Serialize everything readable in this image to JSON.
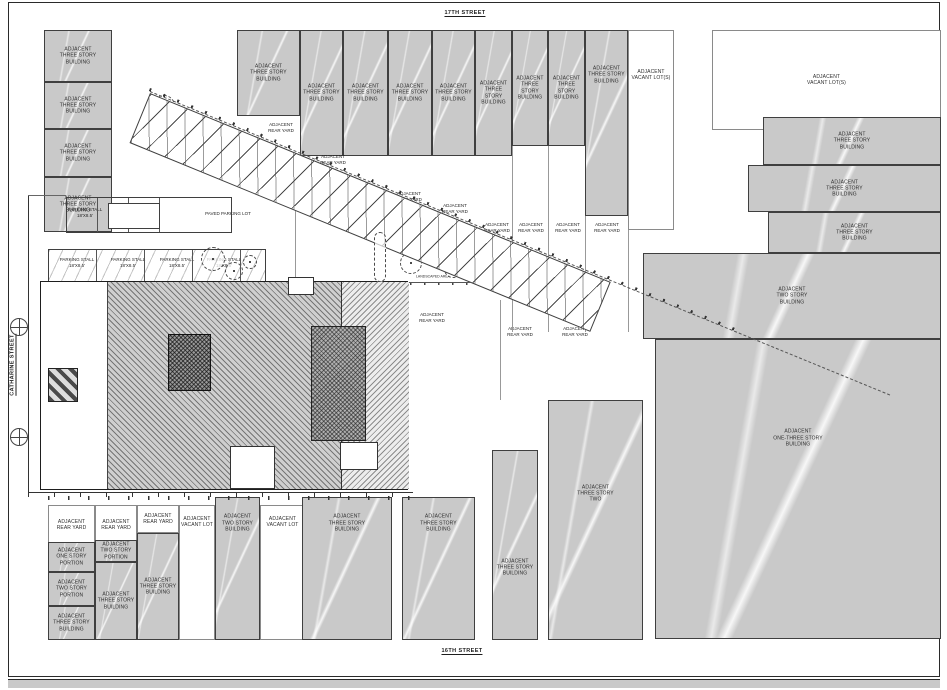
{
  "sheet": {
    "streets": {
      "top": "17TH STREET",
      "bottom": "16TH STREET",
      "left": "CATHARINE STREET",
      "right": "FITZWATER STREET"
    },
    "colors": {
      "parcel_fill": "#c9c9c9",
      "parcel_border": "#3f3f3f",
      "paper": "#ffffff",
      "line": "#4a4a4a"
    }
  },
  "parcels": [
    {
      "text": "ADJACENT\nTHREE STORY\nBUILDING",
      "x": 44,
      "y": 30,
      "w": 68,
      "h": 52,
      "fill": "gray"
    },
    {
      "text": "ADJACENT\nTHREE STORY\nBUILDING",
      "x": 44,
      "y": 82,
      "w": 68,
      "h": 47,
      "fill": "gray"
    },
    {
      "text": "ADJACENT\nTHREE STORY\nBUILDING",
      "x": 44,
      "y": 129,
      "w": 68,
      "h": 48,
      "fill": "gray"
    },
    {
      "text": "ADJACENT\nTHREE STORY\nBUILDING",
      "x": 44,
      "y": 177,
      "w": 68,
      "h": 55,
      "fill": "gray"
    },
    {
      "text": "ADJACENT\nTHREE STORY\nBUILDING",
      "x": 237,
      "y": 30,
      "w": 63,
      "h": 86,
      "fill": "gray"
    },
    {
      "text": "ADJACENT\nTHREE STORY\nBUILDING",
      "x": 300,
      "y": 30,
      "w": 43,
      "h": 126,
      "fill": "gray"
    },
    {
      "text": "ADJACENT\nTHREE STORY\nBUILDING",
      "x": 343,
      "y": 30,
      "w": 45,
      "h": 126,
      "fill": "gray"
    },
    {
      "text": "ADJACENT\nTHREE STORY\nBUILDING",
      "x": 388,
      "y": 30,
      "w": 44,
      "h": 126,
      "fill": "gray"
    },
    {
      "text": "ADJACENT\nTHREE STORY\nBUILDING",
      "x": 432,
      "y": 30,
      "w": 43,
      "h": 126,
      "fill": "gray"
    },
    {
      "text": "ADJACENT\nTHREE STORY\nBUILDING",
      "x": 475,
      "y": 30,
      "w": 37,
      "h": 126,
      "fill": "gray"
    },
    {
      "text": "ADJACENT\nTHREE STORY\nBUILDING",
      "x": 512,
      "y": 30,
      "w": 36,
      "h": 116,
      "fill": "gray"
    },
    {
      "text": "ADJACENT\nTHREE STORY\nBUILDING",
      "x": 548,
      "y": 30,
      "w": 37,
      "h": 116,
      "fill": "gray"
    },
    {
      "text": "ADJACENT\nTHREE STORY\nBUILDING",
      "x": 585,
      "y": 30,
      "w": 43,
      "h": 186,
      "fill": "gray",
      "labelY": 0.24
    },
    {
      "text": "ADJACENT\nVACANT LOT(S)",
      "x": 628,
      "y": 30,
      "w": 46,
      "h": 200,
      "fill": "white",
      "labelY": 0.22
    },
    {
      "text": "ADJACENT\nVACANT LOT(S)",
      "x": 712,
      "y": 30,
      "w": 229,
      "h": 100,
      "fill": "white"
    },
    {
      "text": "ADJACENT\nTHREE STORY\nBUILDING",
      "x": 763,
      "y": 117,
      "w": 178,
      "h": 48,
      "fill": "gray"
    },
    {
      "text": "ADJACENT\nTHREE STORY\nBUILDING",
      "x": 748,
      "y": 165,
      "w": 193,
      "h": 47,
      "fill": "gray"
    },
    {
      "text": "ADJACENT\nTHREE STORY\nBUILDING",
      "x": 768,
      "y": 212,
      "w": 173,
      "h": 41,
      "fill": "gray"
    },
    {
      "text": "ADJACENT\nTWO STORY\nBUILDING",
      "x": 643,
      "y": 253,
      "w": 298,
      "h": 86,
      "fill": "gray"
    },
    {
      "text": "ADJACENT\nONE-THREE STORY\nBUILDING",
      "x": 655,
      "y": 339,
      "w": 286,
      "h": 300,
      "fill": "gray",
      "labelY": 0.33
    },
    {
      "text": "ADJACENT\nTHREE STORY\nBUILDING",
      "x": 492,
      "y": 450,
      "w": 46,
      "h": 190,
      "fill": "gray",
      "labelY": 0.62
    },
    {
      "text": "ADJACENT\nTHREE STORY\nTWO",
      "x": 548,
      "y": 400,
      "w": 95,
      "h": 240,
      "fill": "gray",
      "labelY": 0.39
    },
    {
      "text": "ADJACENT\nREAR YARD",
      "x": 48,
      "y": 505,
      "w": 47,
      "h": 40,
      "fill": "white"
    },
    {
      "text": "ADJACENT\nREAR YARD",
      "x": 95,
      "y": 505,
      "w": 42,
      "h": 40,
      "fill": "white"
    },
    {
      "text": "ADJACENT\nREAR YARD",
      "x": 137,
      "y": 505,
      "w": 42,
      "h": 28,
      "fill": "white"
    },
    {
      "text": "ADJACENT\nVACANT LOT",
      "x": 179,
      "y": 505,
      "w": 36,
      "h": 135,
      "fill": "white",
      "labelY": 0.12
    },
    {
      "text": "ADJACENT\nTWO STORY\nBUILDING",
      "x": 215,
      "y": 497,
      "w": 45,
      "h": 143,
      "fill": "gray",
      "labelY": 0.18
    },
    {
      "text": "ADJACENT\nVACANT LOT",
      "x": 260,
      "y": 505,
      "w": 45,
      "h": 135,
      "fill": "white",
      "labelY": 0.12
    },
    {
      "text": "ADJACENT\nTHREE STORY\nBUILDING",
      "x": 302,
      "y": 497,
      "w": 90,
      "h": 143,
      "fill": "gray",
      "labelY": 0.18
    },
    {
      "text": "ADJACENT\nTHREE STORY\nBUILDING",
      "x": 402,
      "y": 497,
      "w": 73,
      "h": 143,
      "fill": "gray",
      "labelY": 0.18
    },
    {
      "text": "ADJACENT\nONE STORY\nPORTION",
      "x": 48,
      "y": 542,
      "w": 47,
      "h": 30,
      "fill": "gray"
    },
    {
      "text": "ADJACENT\nTWO STORY\nPORTION",
      "x": 48,
      "y": 572,
      "w": 47,
      "h": 34,
      "fill": "gray"
    },
    {
      "text": "ADJACENT\nTHREE STORY\nBUILDING",
      "x": 48,
      "y": 606,
      "w": 47,
      "h": 34,
      "fill": "gray"
    },
    {
      "text": "ADJACENT\nTWO STORY\nPORTION",
      "x": 95,
      "y": 540,
      "w": 42,
      "h": 22,
      "fill": "gray"
    },
    {
      "text": "ADJACENT\nTHREE STORY\nBUILDING",
      "x": 95,
      "y": 562,
      "w": 42,
      "h": 78,
      "fill": "gray"
    },
    {
      "text": "ADJACENT\nTHREE STORY\nBUILDING",
      "x": 137,
      "y": 533,
      "w": 42,
      "h": 107,
      "fill": "gray"
    }
  ],
  "annotations": [
    {
      "text": "ADJACENT\nREAR YARD",
      "x": 281,
      "y": 128
    },
    {
      "text": "ADJACENT\nREAR YARD",
      "x": 333,
      "y": 160
    },
    {
      "text": "ADJACENT\nREAR YARD",
      "x": 409,
      "y": 197
    },
    {
      "text": "ADJACENT\nREAR YARD",
      "x": 455,
      "y": 209
    },
    {
      "text": "ADJACENT\nREAR YARD",
      "x": 497,
      "y": 228
    },
    {
      "text": "ADJACENT\nREAR YARD",
      "x": 531,
      "y": 228
    },
    {
      "text": "ADJACENT\nREAR YARD",
      "x": 568,
      "y": 228
    },
    {
      "text": "ADJACENT\nREAR YARD",
      "x": 607,
      "y": 228
    },
    {
      "text": "ADJACENT\nREAR YARD",
      "x": 432,
      "y": 318
    },
    {
      "text": "ADJACENT\nREAR YARD",
      "x": 520,
      "y": 332
    },
    {
      "text": "ADJACENT\nREAR YARD",
      "x": 575,
      "y": 332
    },
    {
      "text": "PAVED PARKING LOT",
      "x": 228,
      "y": 214
    },
    {
      "text": "LANDSCAPED AREA",
      "x": 433,
      "y": 277,
      "size": 3.5
    },
    {
      "text": "6' HT. FENCE (N.I.C.)",
      "x": 447,
      "y": 228,
      "rotate": 22,
      "size": 3.5
    },
    {
      "text": "PARKING STALL\n18'X8.5'",
      "x": 85,
      "y": 213
    },
    {
      "text": "PARKING STALL\n18'X8.5'",
      "x": 77,
      "y": 263
    },
    {
      "text": "PARKING STALL\n18'X8.5'",
      "x": 128,
      "y": 263
    },
    {
      "text": "PARKING STALL\n18'X8.5'",
      "x": 177,
      "y": 263
    },
    {
      "text": "PARKING STALL\n18'X8.5'",
      "x": 224,
      "y": 263
    },
    {
      "text": "PARKING STALL\n18'X8.5'",
      "x": 268,
      "y": 148,
      "rotate": 22
    },
    {
      "text": "PARKING STALL\n18'X8.5'",
      "x": 470,
      "y": 232,
      "rotate": 22
    },
    {
      "text": "RESERVOIR SPACE",
      "x": 134,
      "y": 215,
      "size": 4,
      "bold": true
    },
    {
      "text": "EXISTING THREE\nSTORY PORTION",
      "x": 80,
      "y": 338
    },
    {
      "text": "PROPOSED SIX STORY PORTION",
      "x": 260,
      "y": 359,
      "halo": true
    },
    {
      "text": "RECESSED PORTION\n@ 1ST FLOOR",
      "x": 86,
      "y": 406,
      "align": "left",
      "size": 4
    },
    {
      "text": "EXISTING AWNING\nTO BE REMOVED",
      "x": 86,
      "y": 425,
      "align": "left",
      "size": 4
    },
    {
      "text": "EXISTING\nBILCO DOOR",
      "x": 44,
      "y": 297,
      "rotate": -90,
      "size": 3.5
    }
  ],
  "trees": [
    {
      "x": 163,
      "y": 105,
      "r": 10
    },
    {
      "x": 168,
      "y": 126,
      "r": 5
    },
    {
      "x": 212,
      "y": 258,
      "r": 11
    },
    {
      "x": 233,
      "y": 270,
      "r": 8
    },
    {
      "x": 249,
      "y": 261,
      "r": 6
    },
    {
      "x": 363,
      "y": 218,
      "r": 12
    },
    {
      "x": 403,
      "y": 240,
      "r": 10
    },
    {
      "x": 427,
      "y": 247,
      "r": 8
    },
    {
      "x": 410,
      "y": 262,
      "r": 10
    },
    {
      "x": 452,
      "y": 268,
      "r": 8
    },
    {
      "x": 472,
      "y": 270,
      "r": 9
    }
  ]
}
